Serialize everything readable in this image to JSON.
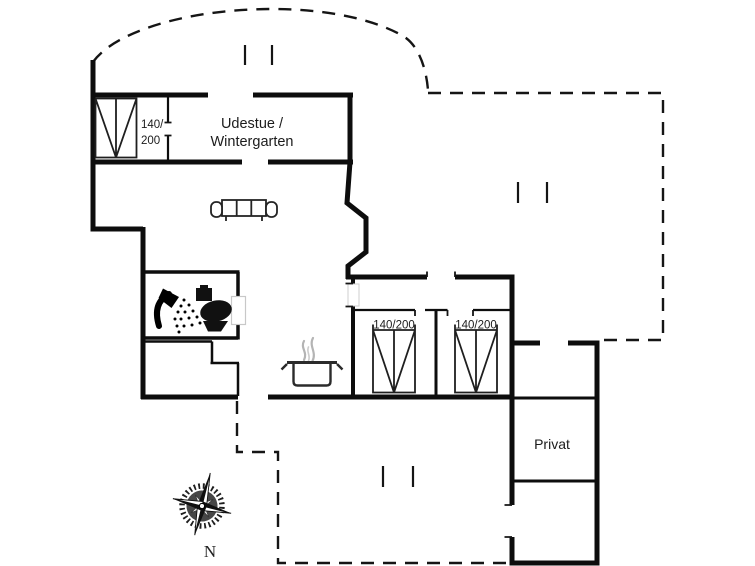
{
  "colors": {
    "wall_ink": "#111111",
    "background": "#ffffff",
    "steam_gray": "#b4b4b4"
  },
  "rooms": {
    "udestue": {
      "name_line1": "Udestue /",
      "name_line2": "Wintergarten"
    },
    "privat": {
      "name": "Privat"
    }
  },
  "beds": {
    "alcove": {
      "size_line1": "140/",
      "size_line2": "200"
    },
    "left": {
      "size": "140/200"
    },
    "right": {
      "size": "140/200"
    }
  },
  "compass": {
    "north": "N"
  },
  "icons": {
    "sofa": "sofa-icon",
    "shower": "shower-icon",
    "toilet": "toilet-icon",
    "cooking_pot": "cooking-pot-icon",
    "steam": "steam-icon",
    "compass_rose": "compass-rose-icon"
  }
}
